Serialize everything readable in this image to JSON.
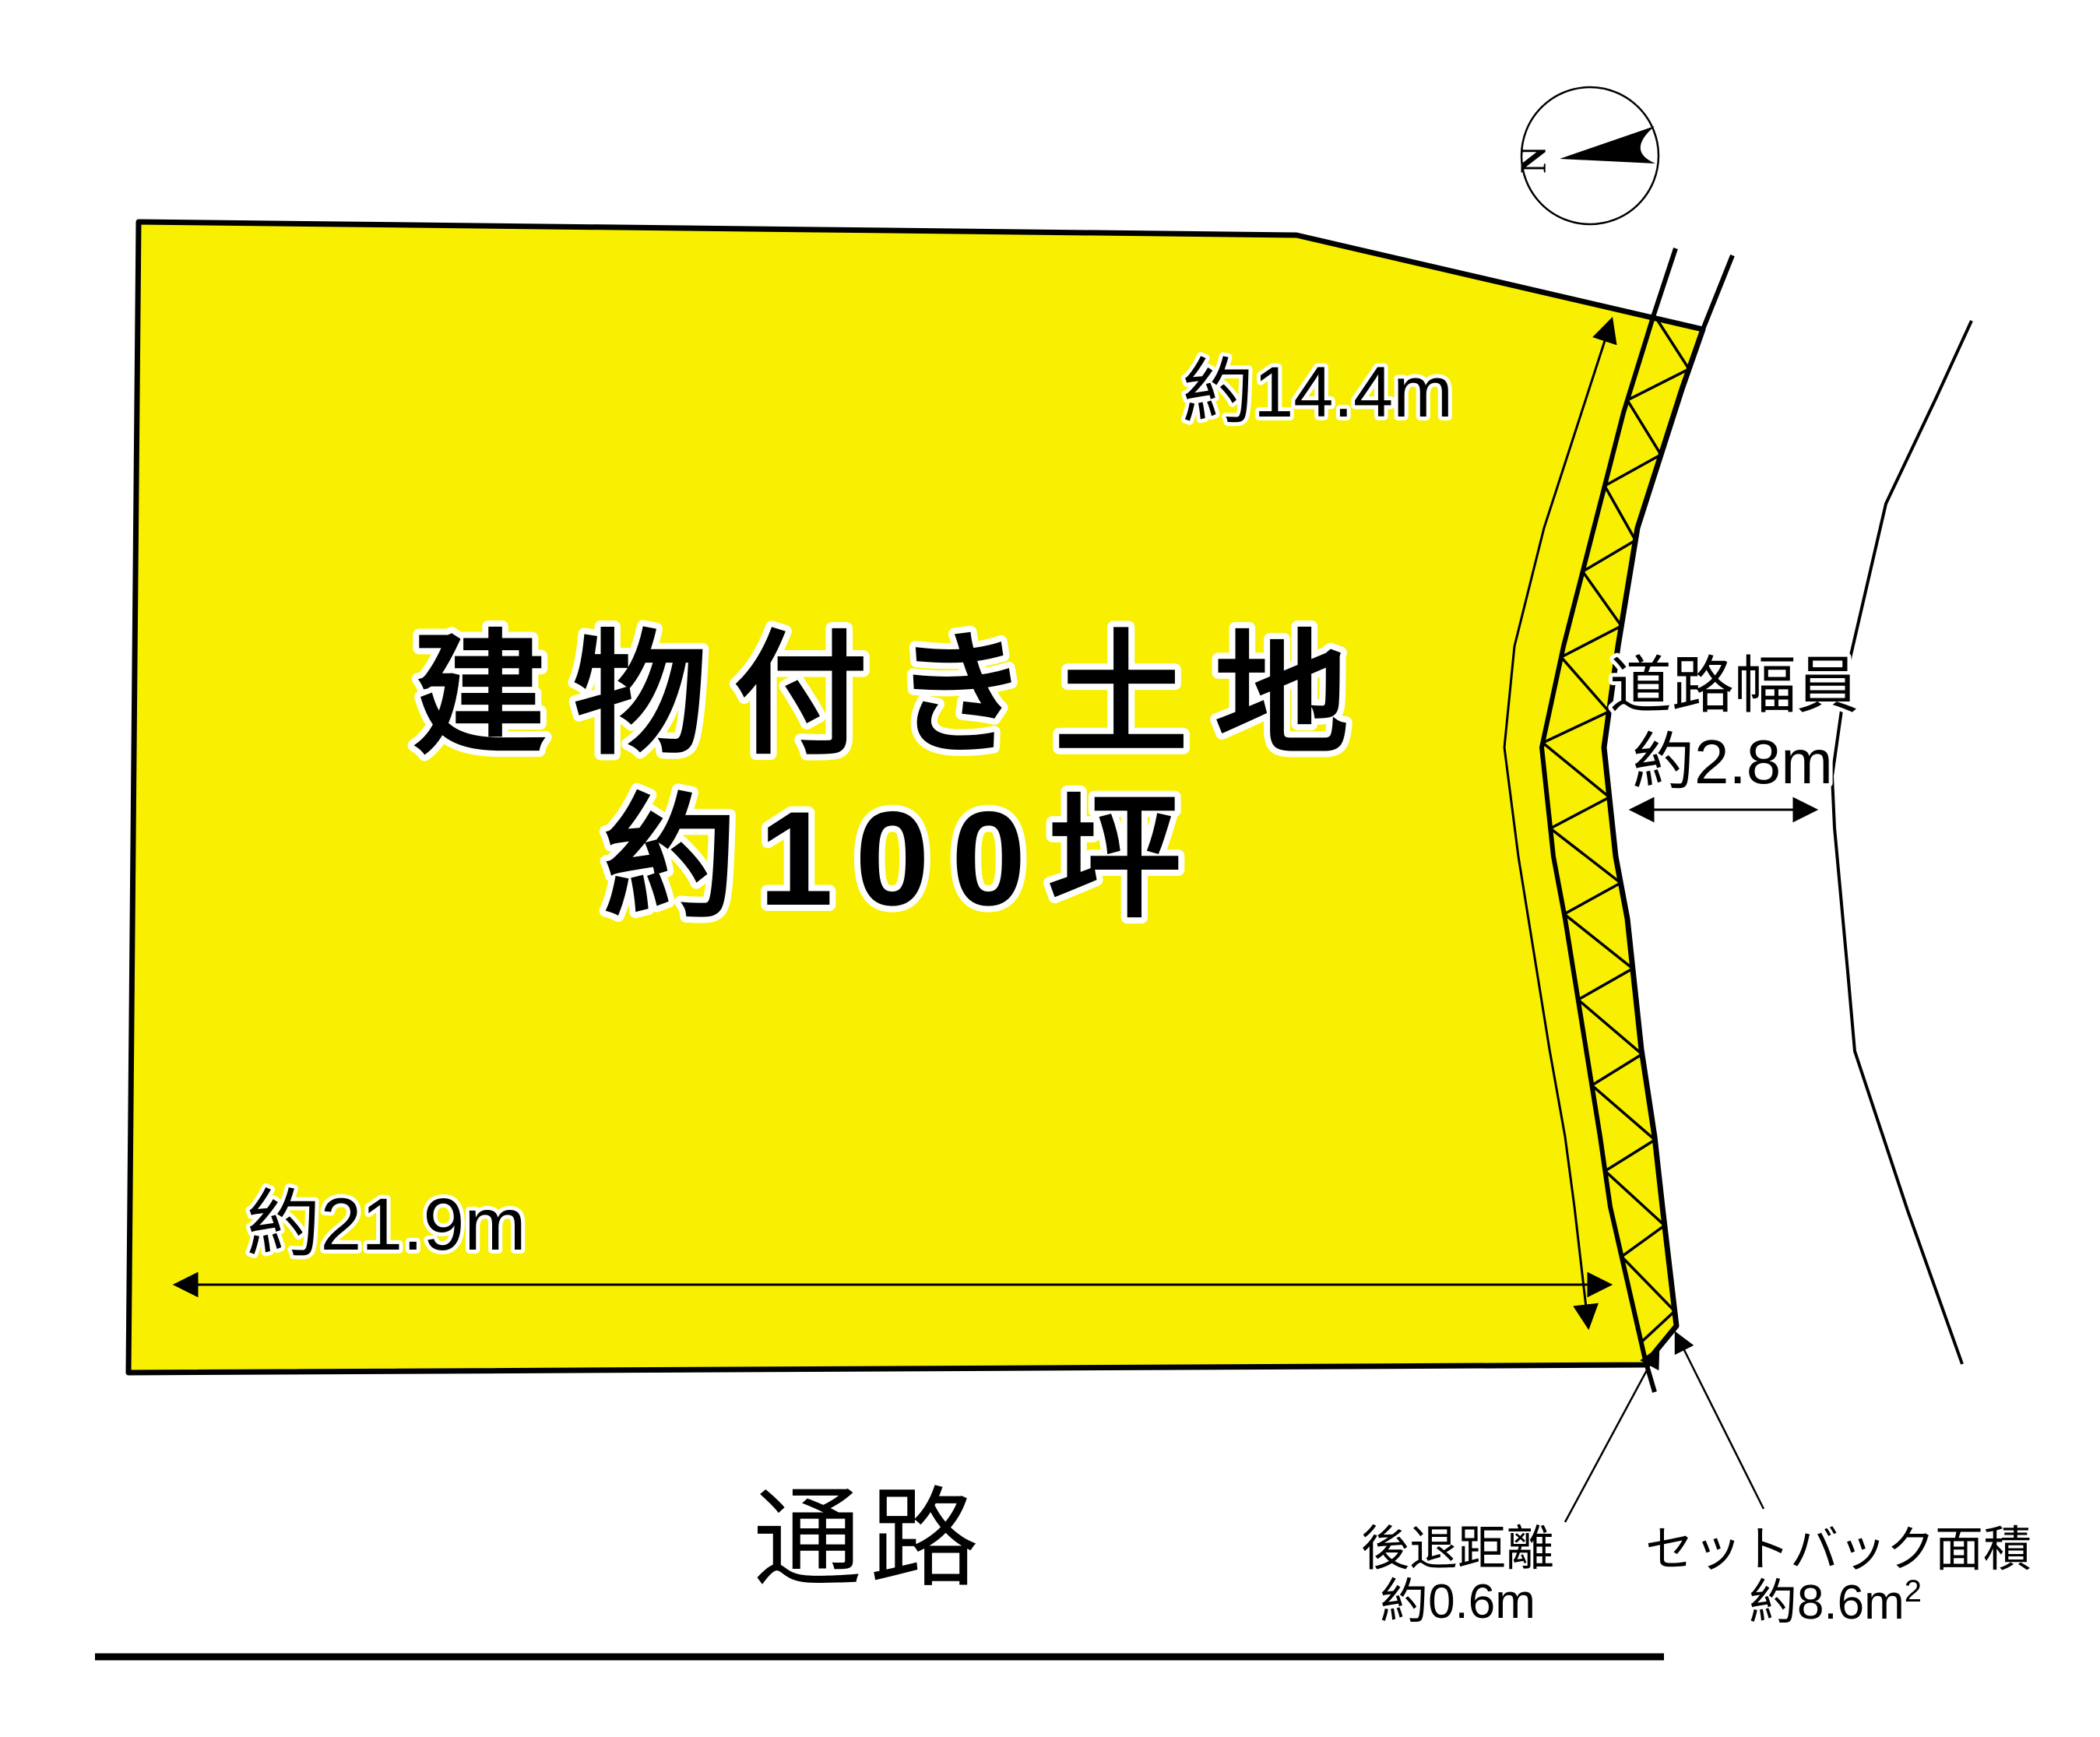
{
  "compass": {
    "north": "N"
  },
  "plot": {
    "title_line1": "建物付き土地",
    "title_line2": "約100坪"
  },
  "dimensions": {
    "east_side": "約14.4m",
    "south_side": "約21.9m",
    "road_width_line1": "道路幅員",
    "road_width_line2": "約2.8m",
    "setback_distance_line1": "後退距離",
    "setback_distance_line2": "約0.6m",
    "setback_area_line1": "セットバック面積",
    "setback_area_value": "約8.6m",
    "setback_area_sup": "2"
  },
  "labels": {
    "passage": "通路"
  },
  "colors": {
    "plot_fill": "#f8f000",
    "line_color": "#000000"
  }
}
